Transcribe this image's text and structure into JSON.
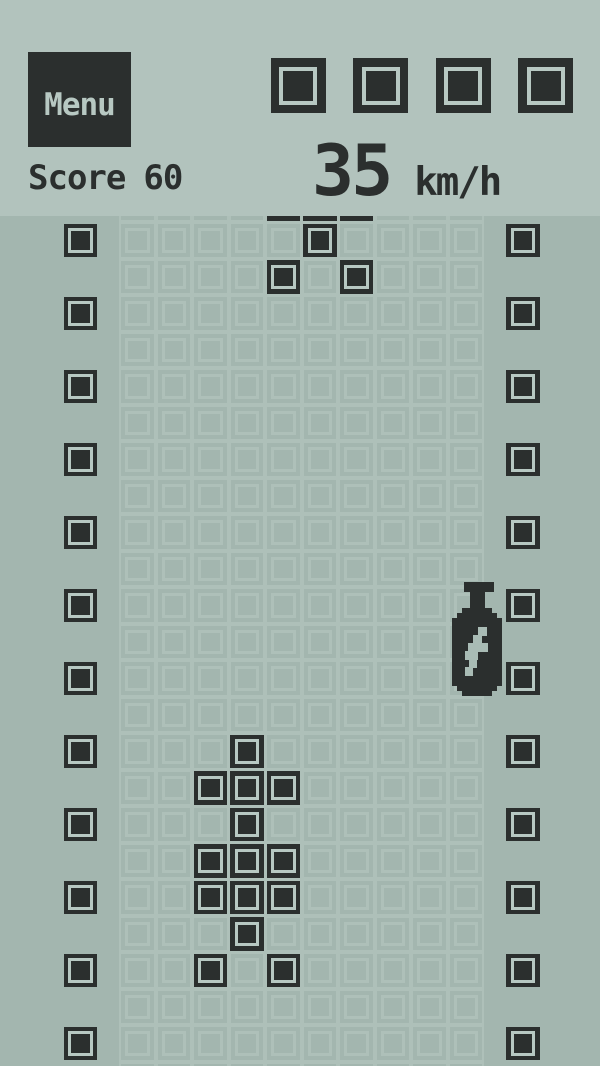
{
  "colors": {
    "header_bg": "#b2c3bd",
    "field_bg": "#a3b6af",
    "block_dark": "#2b2f2e",
    "ring_light": "#b7c8c2",
    "grid_faint": "#aec0b9",
    "bolt_light": "#a9bcb5",
    "menu_text": "#b7c8c2"
  },
  "header": {
    "menu_label": "Menu",
    "score": {
      "label": "Score",
      "value": "60"
    },
    "lives": 4,
    "speed": {
      "value": "35",
      "unit": "km/h"
    }
  },
  "field": {
    "cols": 10,
    "rows": 24,
    "cell_size": 36.5,
    "wall_rows": [
      0,
      2,
      4,
      6,
      8,
      10,
      12,
      14,
      16,
      18,
      20,
      22
    ],
    "enemy_car_cells": [
      [
        -1,
        4
      ],
      [
        -1,
        5
      ],
      [
        -1,
        6
      ],
      [
        0,
        5
      ],
      [
        1,
        4
      ],
      [
        1,
        6
      ]
    ],
    "player_car_cells": [
      [
        14,
        3
      ],
      [
        15,
        2
      ],
      [
        15,
        3
      ],
      [
        15,
        4
      ],
      [
        16,
        3
      ],
      [
        17,
        2
      ],
      [
        17,
        3
      ],
      [
        17,
        4
      ],
      [
        18,
        2
      ],
      [
        18,
        3
      ],
      [
        18,
        4
      ],
      [
        19,
        3
      ],
      [
        20,
        2
      ],
      [
        20,
        4
      ]
    ],
    "bonus": {
      "icon": "fuel-nitro-bottle",
      "x": 452,
      "y": 582
    }
  }
}
